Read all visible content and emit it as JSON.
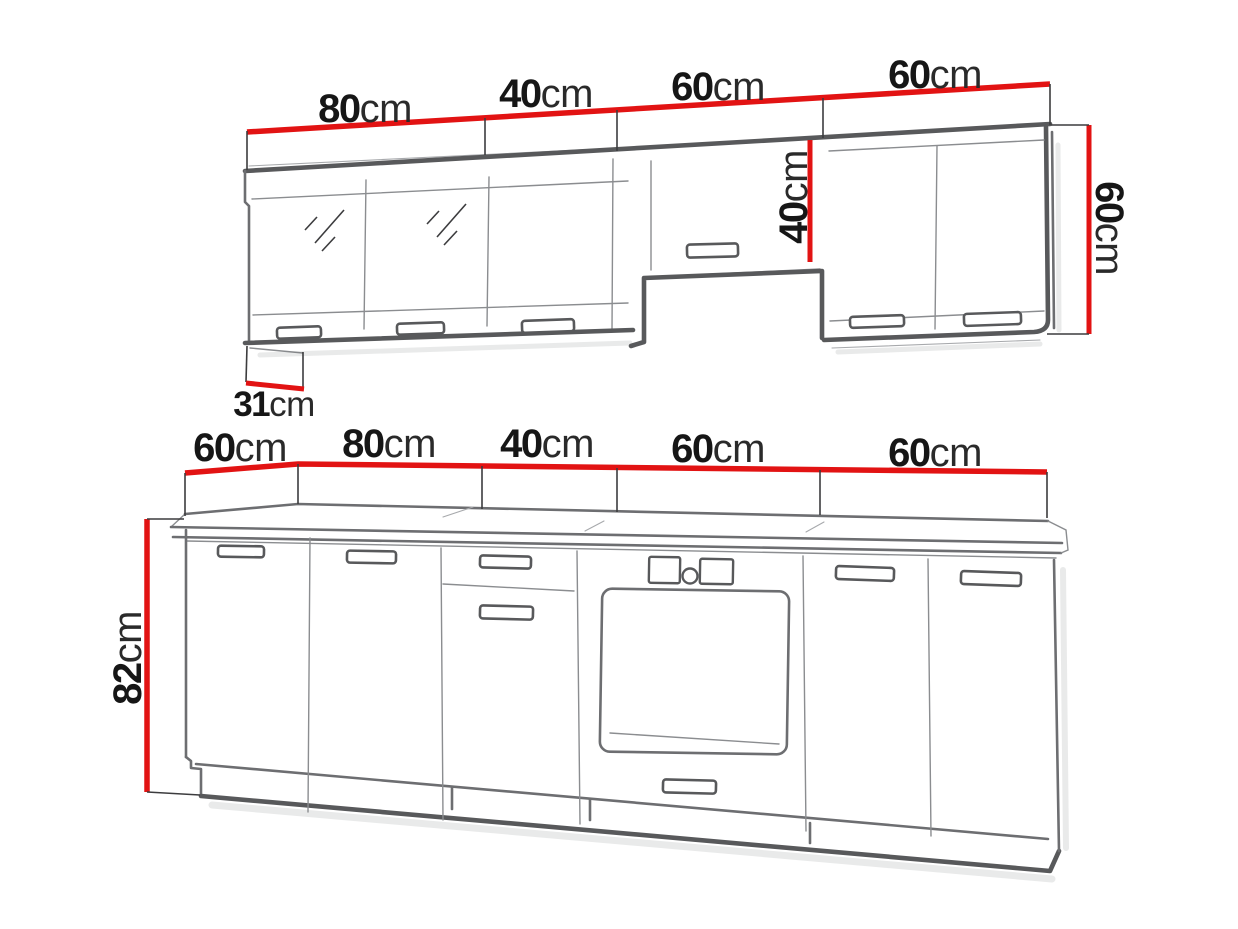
{
  "diagram_title": "Kitchen cabinet set dimension diagram",
  "colors": {
    "dimension_red": "#e21313",
    "outline_dark": "#58595b",
    "outline_mid": "#6d6e71",
    "outline_light": "#8b8d90",
    "label_black": "#161616",
    "background": "#ffffff"
  },
  "upper_row": {
    "width_labels": [
      {
        "num": "80",
        "unit": "cm"
      },
      {
        "num": "40",
        "unit": "cm"
      },
      {
        "num": "60",
        "unit": "cm"
      },
      {
        "num": "60",
        "unit": "cm"
      }
    ],
    "mid_cabinet_height": {
      "num": "40",
      "unit": "cm"
    },
    "right_cabinet_height": {
      "num": "60",
      "unit": "cm"
    },
    "cabinet_depth": {
      "num": "31",
      "unit": "cm"
    }
  },
  "base_row": {
    "width_labels": [
      {
        "num": "60",
        "unit": "cm"
      },
      {
        "num": "80",
        "unit": "cm"
      },
      {
        "num": "40",
        "unit": "cm"
      },
      {
        "num": "60",
        "unit": "cm"
      },
      {
        "num": "60",
        "unit": "cm"
      }
    ],
    "cabinet_height": {
      "num": "82",
      "unit": "cm"
    }
  }
}
